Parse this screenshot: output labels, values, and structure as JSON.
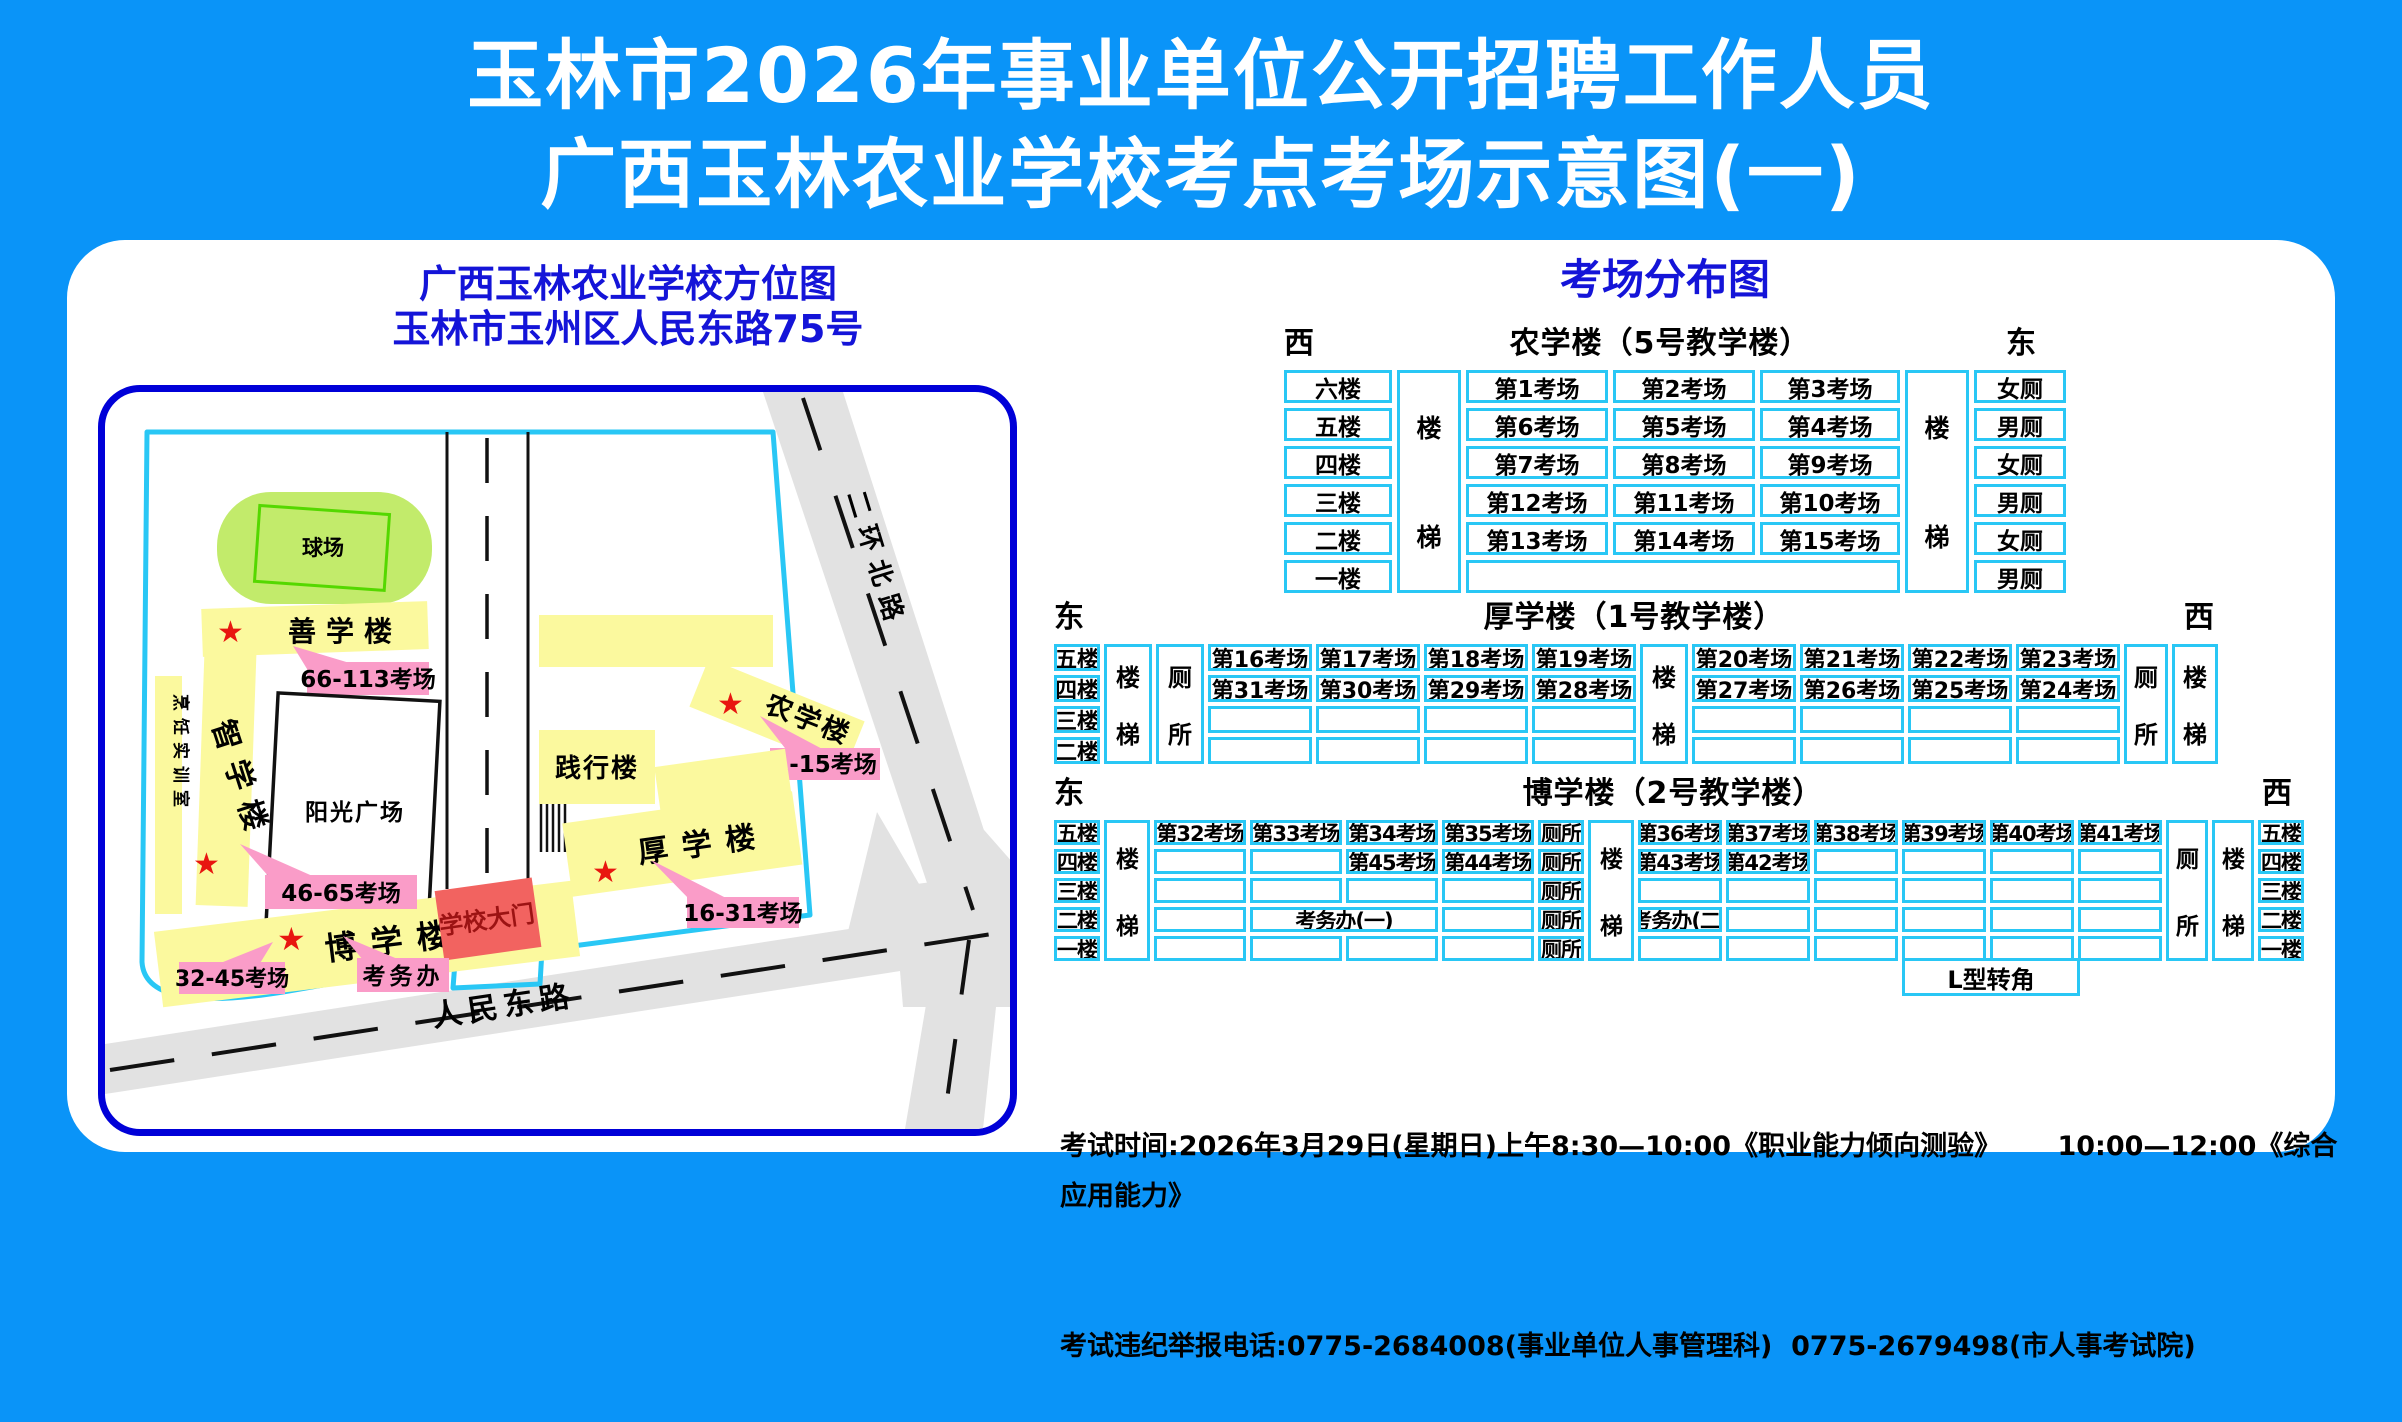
{
  "title": {
    "line1": "玉林市2026年事业单位公开招聘工作人员",
    "line2": "广西玉林农业学校考点考场示意图(一)"
  },
  "colors": {
    "background_blue": "#0A94F8",
    "table_border_cyan": "#29C7F5",
    "map_border_blue": "#0000D8",
    "heading_blue": "#1414D8",
    "building_yellow": "#FBF99E",
    "label_pink": "#FA9CC8",
    "gate_red": "#F26360",
    "field_green": "#C2EB6B",
    "road_gray": "#E2E2E2",
    "star_red": "#E81610"
  },
  "symbols": {
    "star": "★"
  },
  "map": {
    "title_line1": "广西玉林农业学校方位图",
    "title_line2": "玉林市玉州区人民东路75号",
    "playground": "球场",
    "shanxue_building": "善学楼",
    "label_66_113": "66-113考场",
    "cooking_room": "烹饪实训室",
    "zhixue_building": "智学楼",
    "sunshine_plaza": "阳光广场",
    "jianxing_building": "践行楼",
    "nongxue_building": "农学楼",
    "label_1_15": "1-15考场",
    "houxue_building": "厚学楼",
    "label_16_31": "16-31考场",
    "school_gate": "学校大门",
    "boxue_building": "博学楼",
    "exam_office": "考务办",
    "label_32_45": "32-45考场",
    "label_46_65": "46-65考场",
    "road_south": "人民东路",
    "road_east": "二环北路"
  },
  "dist": {
    "heading": "考场分布图",
    "t1": {
      "dir_left": "西",
      "title": "农学楼（5号教学楼）",
      "dir_right": "东",
      "floors": [
        "六楼",
        "五楼",
        "四楼",
        "三楼",
        "二楼",
        "一楼"
      ],
      "stair_top": "楼",
      "stair_bottom": "梯",
      "rooms": [
        [
          "第1考场",
          "第2考场",
          "第3考场"
        ],
        [
          "第6考场",
          "第5考场",
          "第4考场"
        ],
        [
          "第7考场",
          "第8考场",
          "第9考场"
        ],
        [
          "第12考场",
          "第11考场",
          "第10考场"
        ],
        [
          "第13考场",
          "第14考场",
          "第15考场"
        ]
      ],
      "toilets": [
        "女厕",
        "男厕",
        "女厕",
        "男厕",
        "女厕",
        "男厕"
      ]
    },
    "t2": {
      "dir_left": "东",
      "title": "厚学楼（1号教学楼）",
      "dir_right": "西",
      "floors": [
        "五楼",
        "四楼",
        "三楼",
        "二楼"
      ],
      "stair_top": "楼",
      "stair_bottom": "梯",
      "toilet_top": "厕",
      "toilet_bottom": "所",
      "left_rooms": [
        [
          "第16考场",
          "第17考场",
          "第18考场",
          "第19考场"
        ],
        [
          "第31考场",
          "第30考场",
          "第29考场",
          "第28考场"
        ],
        [
          "",
          "",
          "",
          ""
        ],
        [
          "",
          "",
          "",
          ""
        ]
      ],
      "right_rooms": [
        [
          "第20考场",
          "第21考场",
          "第22考场",
          "第23考场"
        ],
        [
          "第27考场",
          "第26考场",
          "第25考场",
          "第24考场"
        ],
        [
          "",
          "",
          "",
          ""
        ],
        [
          "",
          "",
          "",
          ""
        ]
      ]
    },
    "t3": {
      "dir_left": "东",
      "title": "博学楼（2号教学楼）",
      "dir_right": "西",
      "floors_left": [
        "五楼",
        "四楼",
        "三楼",
        "二楼",
        "一楼"
      ],
      "floors_right": [
        "五楼",
        "四楼",
        "三楼",
        "二楼",
        "一楼"
      ],
      "stair_top": "楼",
      "stair_bottom": "梯",
      "toilet_top": "厕",
      "toilet_bottom": "所",
      "left_rooms": [
        [
          "第32考场",
          "第33考场",
          "第34考场",
          "第35考场"
        ],
        [
          "",
          "",
          "第45考场",
          "第44考场"
        ],
        [
          "",
          "",
          "",
          ""
        ],
        [
          "",
          "考务办(一)",
          ""
        ],
        [
          "",
          "",
          "",
          ""
        ]
      ],
      "left_toilets": [
        "厕所",
        "厕所",
        "厕所",
        "厕所",
        "厕所"
      ],
      "right_rooms": [
        [
          "第36考场",
          "第37考场",
          "第38考场",
          "第39考场",
          "第40考场",
          "第41考场"
        ],
        [
          "第43考场",
          "第42考场",
          "",
          "",
          "",
          ""
        ],
        [
          "",
          "",
          "",
          "",
          "",
          ""
        ],
        [
          "考务办(二)",
          "",
          "",
          "",
          "",
          ""
        ],
        [
          "",
          "",
          "",
          "",
          "",
          ""
        ]
      ],
      "corner_label": "L型转角"
    }
  },
  "footer": {
    "line1": "考试时间:2026年3月29日(星期日)上午8:30—10:00《职业能力倾向测验》      10:00—12:00《综合应用能力》",
    "line2": "考试违纪举报电话:0775-2684008(事业单位人事管理科)  0775-2679498(市人事考试院)"
  }
}
